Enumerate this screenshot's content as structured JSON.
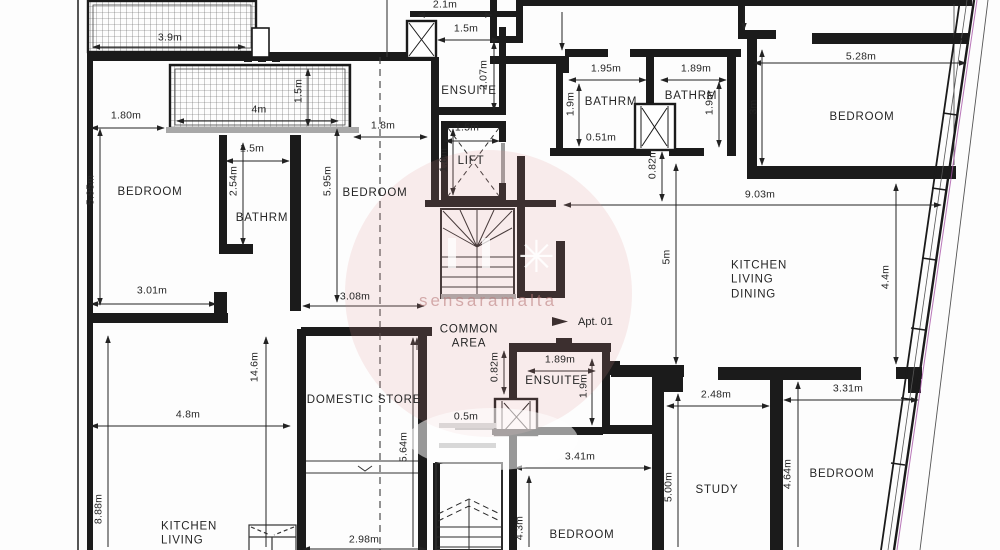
{
  "drawing": {
    "type": "residential floor plan",
    "units": "m",
    "apartment_label": "Apt. 01"
  },
  "watermark": {
    "text": "sensaramalta",
    "star_icon": "✳"
  },
  "rooms": [
    {
      "text": "BEDROOM",
      "x": 150,
      "y": 192
    },
    {
      "text": "BATHRM",
      "x": 262,
      "y": 218
    },
    {
      "text": "BEDROOM",
      "x": 375,
      "y": 193
    },
    {
      "text": "ENSUITE",
      "x": 469,
      "y": 91
    },
    {
      "text": "LIFT",
      "x": 471,
      "y": 161
    },
    {
      "text": "BATHRM",
      "x": 611,
      "y": 102
    },
    {
      "text": "BATHRM",
      "x": 691,
      "y": 96
    },
    {
      "text": "BEDROOM",
      "x": 862,
      "y": 117
    },
    {
      "text": "KITCHEN\nLIVING\nDINING",
      "x": 731,
      "y": 280,
      "align": "left"
    },
    {
      "text": "COMMON\nAREA",
      "x": 469,
      "y": 337
    },
    {
      "text": "ENSUITE",
      "x": 553,
      "y": 381
    },
    {
      "text": "DOMESTIC STORE",
      "x": 364,
      "y": 400
    },
    {
      "text": "KITCHEN\nLIVING",
      "x": 161,
      "y": 534,
      "align": "left"
    },
    {
      "text": "BEDROOM",
      "x": 582,
      "y": 535
    },
    {
      "text": "STUDY",
      "x": 717,
      "y": 490
    },
    {
      "text": "BEDROOM",
      "x": 842,
      "y": 474
    }
  ],
  "dimensions": [
    {
      "text": "3.9m",
      "x": 170,
      "y": 38
    },
    {
      "text": "2.1m",
      "x": 445,
      "y": 5
    },
    {
      "text": "1.5m",
      "x": 466,
      "y": 29
    },
    {
      "text": "2.07m",
      "x": 484,
      "y": 75,
      "v": true
    },
    {
      "text": "1.95m",
      "x": 606,
      "y": 69
    },
    {
      "text": "1.9m",
      "x": 571,
      "y": 104,
      "v": true
    },
    {
      "text": "0.51m",
      "x": 601,
      "y": 138
    },
    {
      "text": "1.89m",
      "x": 696,
      "y": 69
    },
    {
      "text": "1.9m",
      "x": 710,
      "y": 103,
      "v": true
    },
    {
      "text": "3m",
      "x": 754,
      "y": 107,
      "v": true
    },
    {
      "text": "5.28m",
      "x": 861,
      "y": 57
    },
    {
      "text": "9.03m",
      "x": 760,
      "y": 195
    },
    {
      "text": "0.82m",
      "x": 653,
      "y": 164,
      "v": true
    },
    {
      "text": "1.80m",
      "x": 126,
      "y": 116
    },
    {
      "text": "4m",
      "x": 259,
      "y": 110
    },
    {
      "text": "1.5m",
      "x": 299,
      "y": 91,
      "v": true
    },
    {
      "text": "1.8m",
      "x": 383,
      "y": 126
    },
    {
      "text": "1.5m",
      "x": 467,
      "y": 128
    },
    {
      "text": "1.8m",
      "x": 444,
      "y": 160,
      "v": true
    },
    {
      "text": "5.95m",
      "x": 91,
      "y": 190,
      "v": true
    },
    {
      "text": "1.5m",
      "x": 252,
      "y": 149
    },
    {
      "text": "2.54m",
      "x": 234,
      "y": 181,
      "v": true
    },
    {
      "text": "5.95m",
      "x": 328,
      "y": 181,
      "v": true
    },
    {
      "text": "3.01m",
      "x": 152,
      "y": 291
    },
    {
      "text": "3.08m",
      "x": 355,
      "y": 297
    },
    {
      "text": "1.89m",
      "x": 560,
      "y": 360
    },
    {
      "text": "1.9m",
      "x": 584,
      "y": 386,
      "v": true
    },
    {
      "text": "0.82m",
      "x": 495,
      "y": 367,
      "v": true
    },
    {
      "text": "0.5m",
      "x": 466,
      "y": 417
    },
    {
      "text": "3.41m",
      "x": 580,
      "y": 457
    },
    {
      "text": "5m",
      "x": 667,
      "y": 257,
      "v": true
    },
    {
      "text": "4.4m",
      "x": 886,
      "y": 277,
      "v": true
    },
    {
      "text": "14.6m",
      "x": 255,
      "y": 367,
      "v": true
    },
    {
      "text": "4.8m",
      "x": 188,
      "y": 415
    },
    {
      "text": "8.88m",
      "x": 99,
      "y": 509,
      "v": true
    },
    {
      "text": "5.64m",
      "x": 404,
      "y": 447,
      "v": true
    },
    {
      "text": "2.98m",
      "x": 364,
      "y": 540
    },
    {
      "text": "4.3m",
      "x": 520,
      "y": 528,
      "v": true
    },
    {
      "text": "2.48m",
      "x": 716,
      "y": 395
    },
    {
      "text": "5.00m",
      "x": 669,
      "y": 487,
      "v": true
    },
    {
      "text": "3.31m",
      "x": 848,
      "y": 389
    },
    {
      "text": "4.64m",
      "x": 788,
      "y": 474,
      "v": true
    }
  ]
}
